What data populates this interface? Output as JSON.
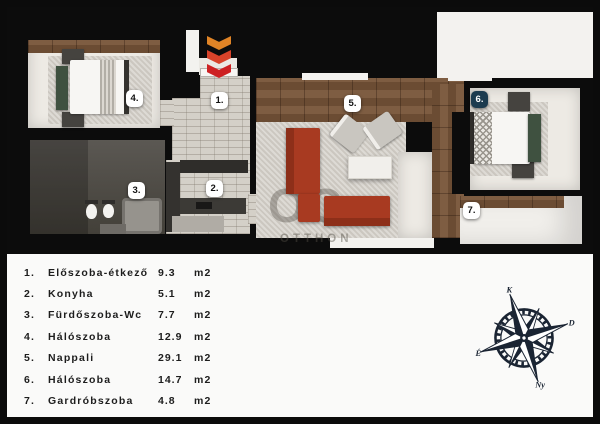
{
  "rooms": [
    {
      "num": "1.",
      "name": "Előszoba-étkező",
      "area": "9.3",
      "unit": "m2"
    },
    {
      "num": "2.",
      "name": "Konyha",
      "area": "5.1",
      "unit": "m2"
    },
    {
      "num": "3.",
      "name": "Fürdőszoba-Wc",
      "area": "7.7",
      "unit": "m2"
    },
    {
      "num": "4.",
      "name": "Hálószoba",
      "area": "12.9",
      "unit": "m2"
    },
    {
      "num": "5.",
      "name": "Nappali",
      "area": "29.1",
      "unit": "m2"
    },
    {
      "num": "6.",
      "name": "Hálószoba",
      "area": "14.7",
      "unit": "m2"
    },
    {
      "num": "7.",
      "name": "Gardróbszoba",
      "area": "4.8",
      "unit": "m2"
    }
  ],
  "watermark": {
    "line1": "OC",
    "line2": "OTTHON"
  },
  "compass": {
    "north": "É",
    "east": "K",
    "south": "D",
    "west": "Ny",
    "rotation_deg": -18
  },
  "entrance": {
    "marker": "chevron-arrows-down",
    "chevron_colors": [
      "#e08426",
      "#d8432a",
      "#cd2123"
    ]
  },
  "colors": {
    "wall_black": "#0b0b0b",
    "legend_bg": "#fafaf9",
    "brick_floor": "#d4d0c8",
    "wood_floor": "#75563c",
    "rug": "#d5d1ca",
    "bath_dark": "#514e49",
    "sofa_red": "#a83a21",
    "bench_green": "#3f5140",
    "badge_bg": "#ffffff",
    "badge6_bg": "#1c3b4f",
    "compass_ink": "#1a2433"
  }
}
